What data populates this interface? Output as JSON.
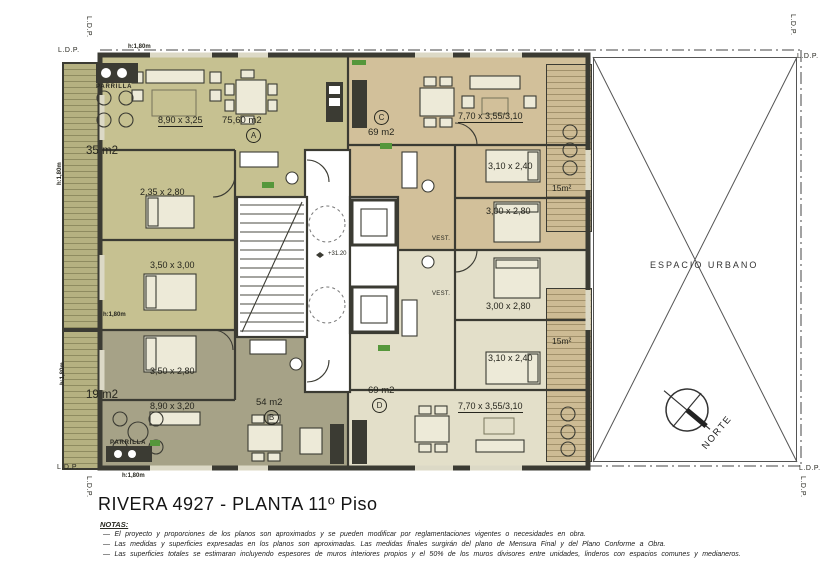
{
  "title": "RIVERA 4927  - PLANTA 11º Piso",
  "notes": {
    "heading": "NOTAS:",
    "items": [
      "—  El proyecto y proporciones de los planos son aproximados y se pueden modificar por reglamentaciones vigentes o necesidades en obra.",
      "—  Las medidas y superficies expresadas en los planos son aproximadas. Las medidas finales surgirán del plano de Mensura Final y del Plano Conforme a Obra.",
      "—  Las superficies totales se estimaran incluyendo espesores de muros interiores propios y el 50% de los muros divisores entre unidades, linderos con espacios comunes y medianeros."
    ]
  },
  "plan": {
    "property_line": "L.D.P.",
    "height_restriction": "h:1,80m",
    "level": "+31.20",
    "espacio_urbano": "ESPACIO URBANO",
    "north": "NORTE",
    "vestibule": "VEST.",
    "parrilla": "PARRILLA",
    "terrace_top_area": "35 m2",
    "terrace_bottom_area": "19 m2",
    "balcony_area": "15m²",
    "units": {
      "a": {
        "badge": "A",
        "area": "75,60 m2",
        "living_dim": "8,90 x 3,25",
        "bed1_dim": "2,35 x 2,80",
        "bed2_dim": "3,50 x 3,00"
      },
      "b": {
        "badge": "B",
        "area": "54 m2",
        "living_dim": "8,90 x 3,20",
        "bed1_dim": "3,50 x 2,80"
      },
      "c": {
        "badge": "C",
        "area": "69 m2",
        "living_dim": "7,70 x 3,55/3,10",
        "bed1_dim": "3,10 x 2,40",
        "bed2_dim": "3,00 x 2,80"
      },
      "d": {
        "badge": "D",
        "area": "69 m2",
        "living_dim": "7,70 x 3,55/3,10",
        "bed1_dim": "3,00 x 2,80",
        "bed2_dim": "3,10 x 2,40"
      }
    }
  },
  "colors": {
    "unit-a": "#c6c191",
    "unit-b": "#a6a287",
    "unit-c": "#d2c09a",
    "unit-d": "#e3dfc9",
    "terrace": "#b5b181",
    "terrace-line": "#8e8b60",
    "balcony": "#cdbb94",
    "balcony-line": "#a2916b",
    "wall": "#3b3b33",
    "accent-green": "#55973b",
    "paper": "#ffffff"
  }
}
